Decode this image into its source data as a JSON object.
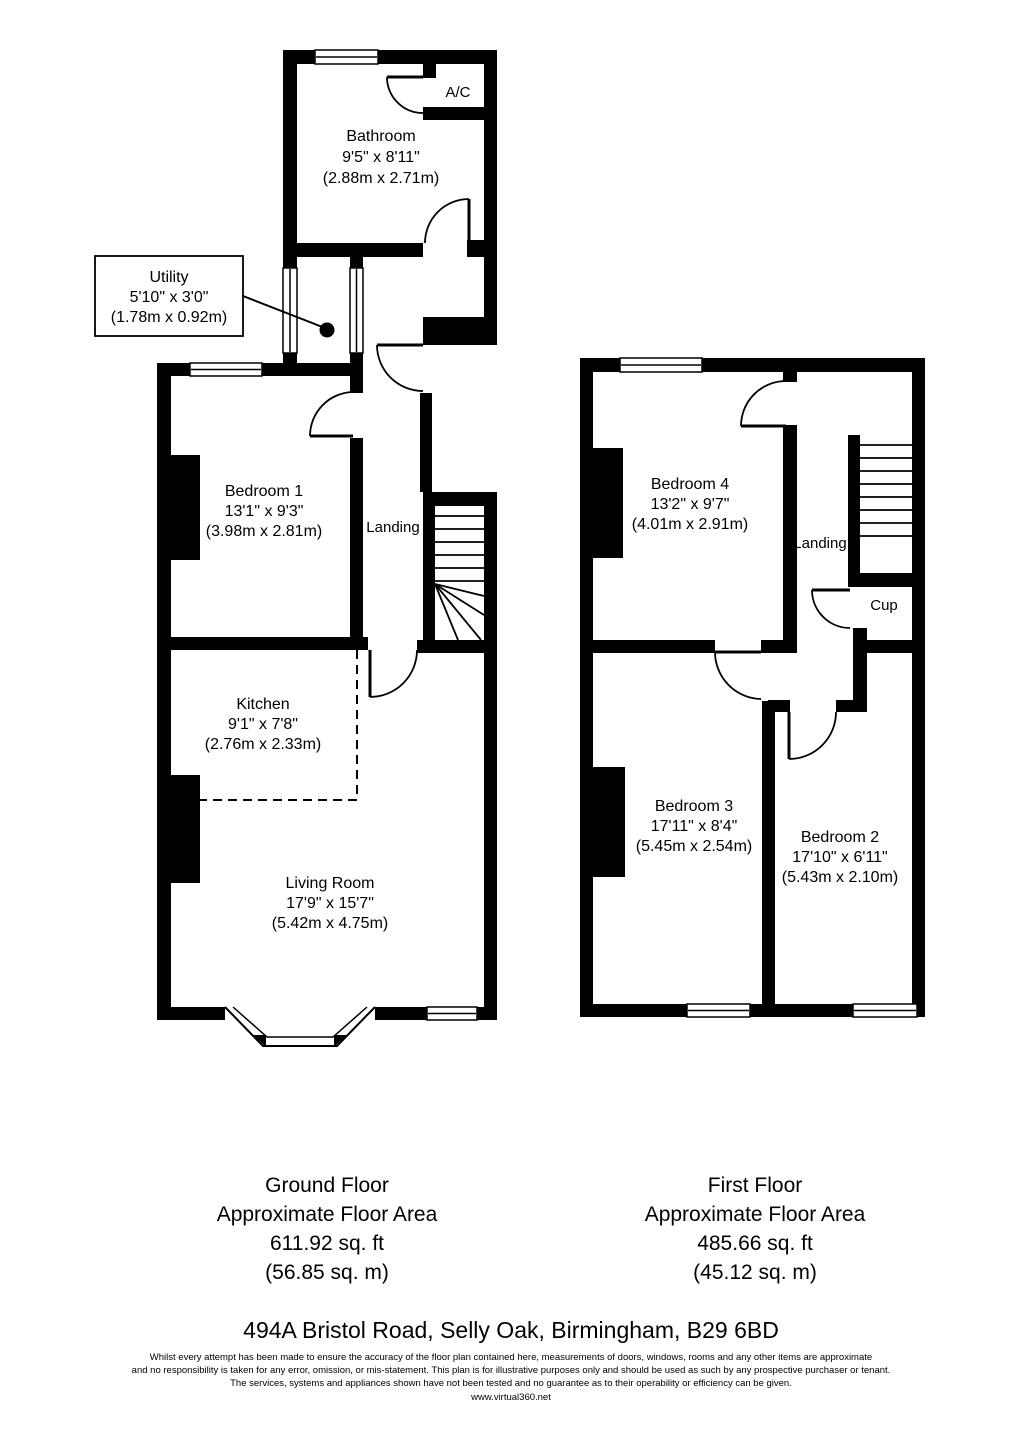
{
  "ground_floor": {
    "rooms": {
      "bathroom": {
        "name": "Bathroom",
        "imperial": "9'5\" x 8'11\"",
        "metric": "(2.88m x 2.71m)"
      },
      "ac_cupboard": {
        "name": "A/C"
      },
      "utility": {
        "name": "Utility",
        "imperial": "5'10\" x 3'0\"",
        "metric": "(1.78m x 0.92m)"
      },
      "bedroom_1": {
        "name": "Bedroom 1",
        "imperial": "13'1\" x 9'3\"",
        "metric": "(3.98m x 2.81m)"
      },
      "landing": {
        "name": "Landing"
      },
      "kitchen": {
        "name": "Kitchen",
        "imperial": "9'1\" x 7'8\"",
        "metric": "(2.76m x 2.33m)"
      },
      "living_room": {
        "name": "Living Room",
        "imperial": "17'9\" x 15'7\"",
        "metric": "(5.42m x 4.75m)"
      }
    },
    "summary": {
      "title": "Ground Floor",
      "subtitle": "Approximate Floor Area",
      "area_ft": "611.92 sq. ft",
      "area_m": "(56.85 sq. m)"
    }
  },
  "first_floor": {
    "rooms": {
      "bedroom_4": {
        "name": "Bedroom 4",
        "imperial": "13'2\" x 9'7\"",
        "metric": "(4.01m x 2.91m)"
      },
      "landing": {
        "name": "Landing"
      },
      "cupboard": {
        "name": "Cup"
      },
      "bedroom_3": {
        "name": "Bedroom 3",
        "imperial": "17'11\" x 8'4\"",
        "metric": "(5.45m x 2.54m)"
      },
      "bedroom_2": {
        "name": "Bedroom 2",
        "imperial": "17'10\" x 6'11\"",
        "metric": "(5.43m x 2.10m)"
      }
    },
    "summary": {
      "title": "First Floor",
      "subtitle": "Approximate Floor Area",
      "area_ft": "485.66 sq. ft",
      "area_m": "(45.12 sq. m)"
    }
  },
  "footer": {
    "address": "494A Bristol Road, Selly Oak, Birmingham, B29 6BD",
    "disclaimer": [
      "Whilst every attempt has been made to ensure the accuracy of the floor plan contained here, measurements of doors, windows, rooms and any other items are approximate",
      "and no responsibility is taken for any error, omission, or mis-statement. This plan is for illustrative purposes only and should be used as such by any prospective purchaser or tenant.",
      "The services, systems and appliances shown have not been tested and no guarantee as to their operability or efficiency can be given."
    ],
    "website": "www.virtual360.net"
  },
  "colors": {
    "wall": "#000000",
    "background": "#ffffff"
  }
}
